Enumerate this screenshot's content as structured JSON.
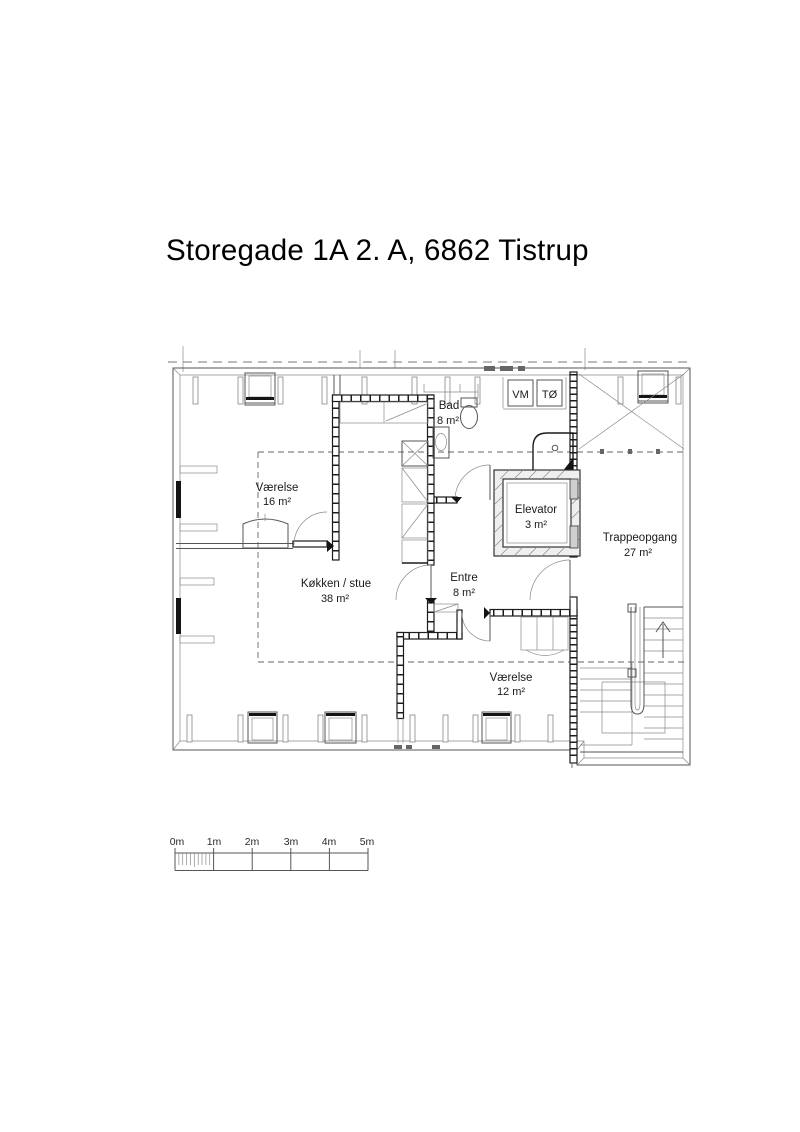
{
  "page": {
    "title": "Storegade 1A 2. A, 6862 Tistrup"
  },
  "plan": {
    "rooms": [
      {
        "name": "Værelse",
        "area": "16 m²"
      },
      {
        "name": "Bad",
        "area": "8 m²"
      },
      {
        "name": "Elevator",
        "area": "3 m²"
      },
      {
        "name": "Trappeopgang",
        "area": "27 m²"
      },
      {
        "name": "Køkken / stue",
        "area": "38 m²"
      },
      {
        "name": "Entre",
        "area": "8 m²"
      },
      {
        "name": "Værelse",
        "area": "12 m²"
      }
    ],
    "appliances": {
      "washing_machine": "VM",
      "tumble_dryer": "TØ"
    }
  },
  "scale_bar": {
    "labels": [
      "0m",
      "1m",
      "2m",
      "3m",
      "4m",
      "5m"
    ]
  },
  "colors": {
    "line": "#1c1c1c",
    "background": "#ffffff"
  }
}
